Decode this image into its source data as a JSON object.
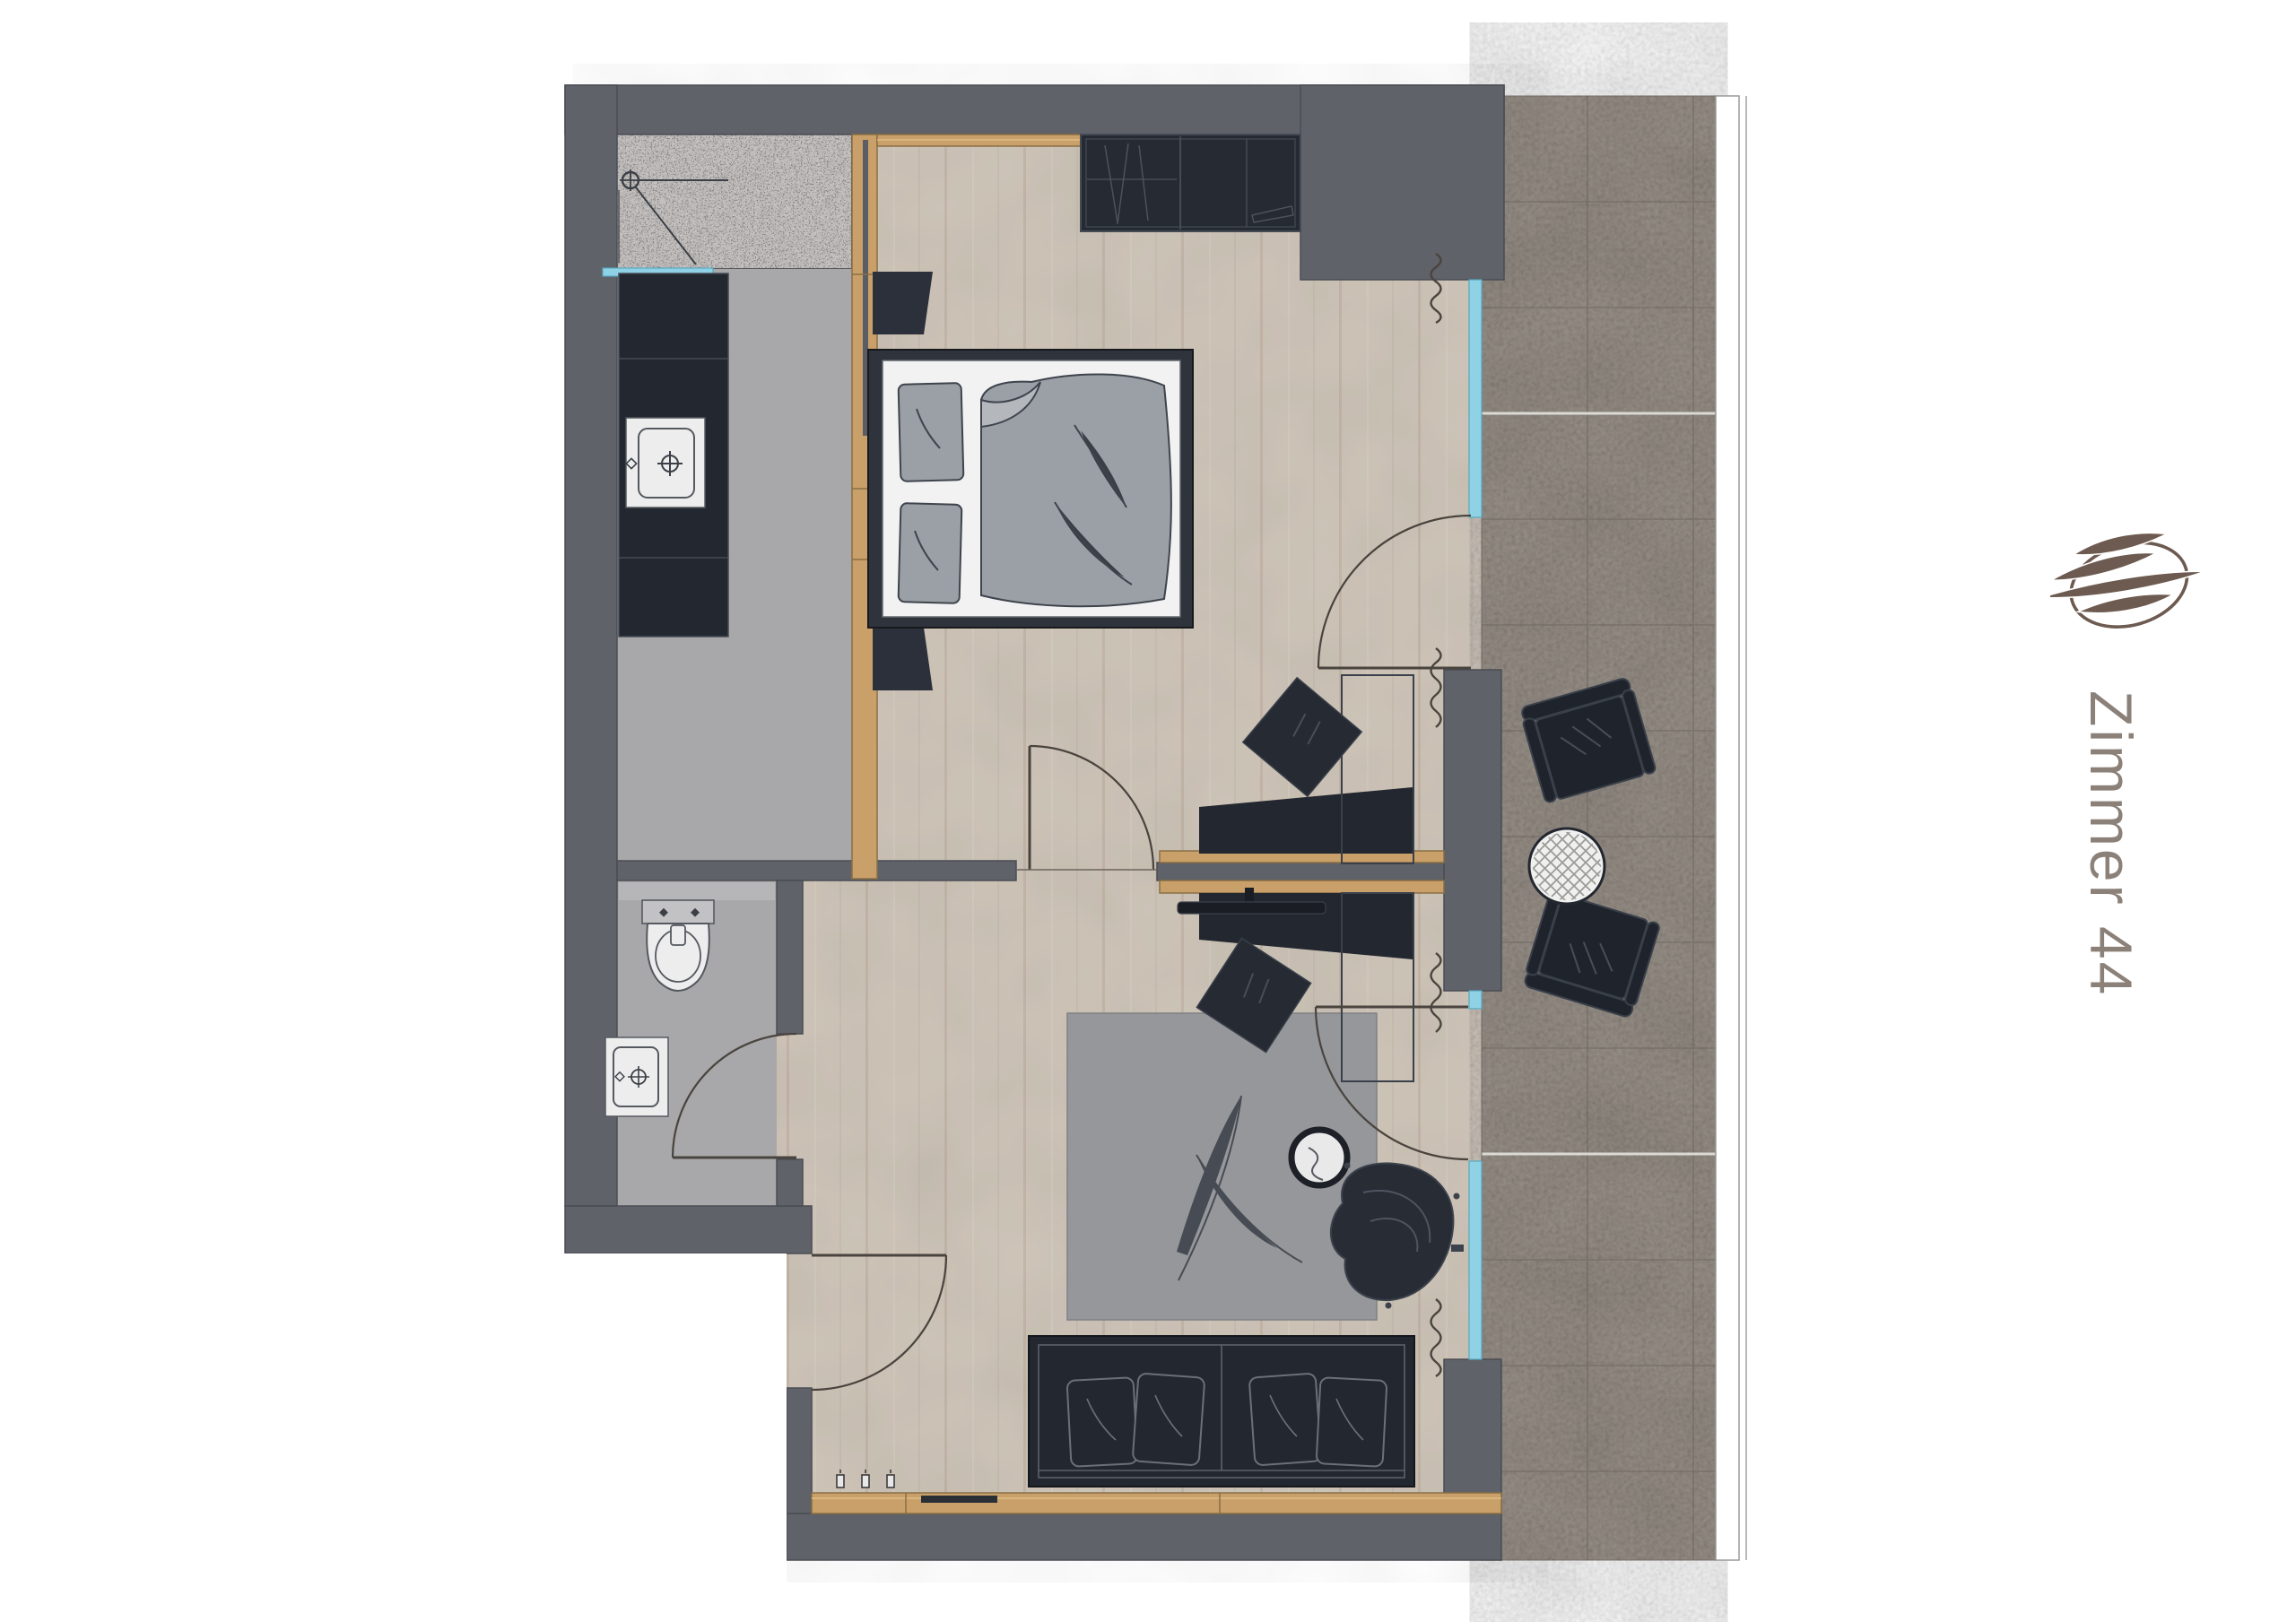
{
  "title_label": "Zimmer 44",
  "logo": {
    "icon": "leaf-ellipse-logo"
  },
  "colors": {
    "wall_gray": "#5f6268",
    "furniture_dark": "#23272f",
    "wood_floor": "#cfc5b9",
    "wood_trim": "#c9a06a",
    "glass_accent": "#8fd2e6",
    "tile_gray": "#8c8379",
    "bath_floor_gray": "#a8a8aa",
    "granite_gray": "#b5b1ae",
    "bed_linen_white": "#f2f2f3",
    "textile_gray": "#9aa0a6",
    "logo_brown": "#6d5a50",
    "label_gray_brown": "#8b8179"
  },
  "rooms": [
    "shower",
    "bathroom-vanity",
    "wc",
    "entry-hall",
    "bedroom",
    "living-area",
    "balcony"
  ],
  "furniture": [
    "shower-head",
    "vanity-sink",
    "toilet",
    "hand-basin",
    "wardrobe",
    "double-bed",
    "nightstand",
    "desk-sideboard",
    "desk-chair",
    "tv",
    "pouf",
    "rug",
    "side-table",
    "lounge-chair",
    "sofa",
    "balcony-armchair",
    "balcony-coffee-table",
    "curtain",
    "door"
  ]
}
